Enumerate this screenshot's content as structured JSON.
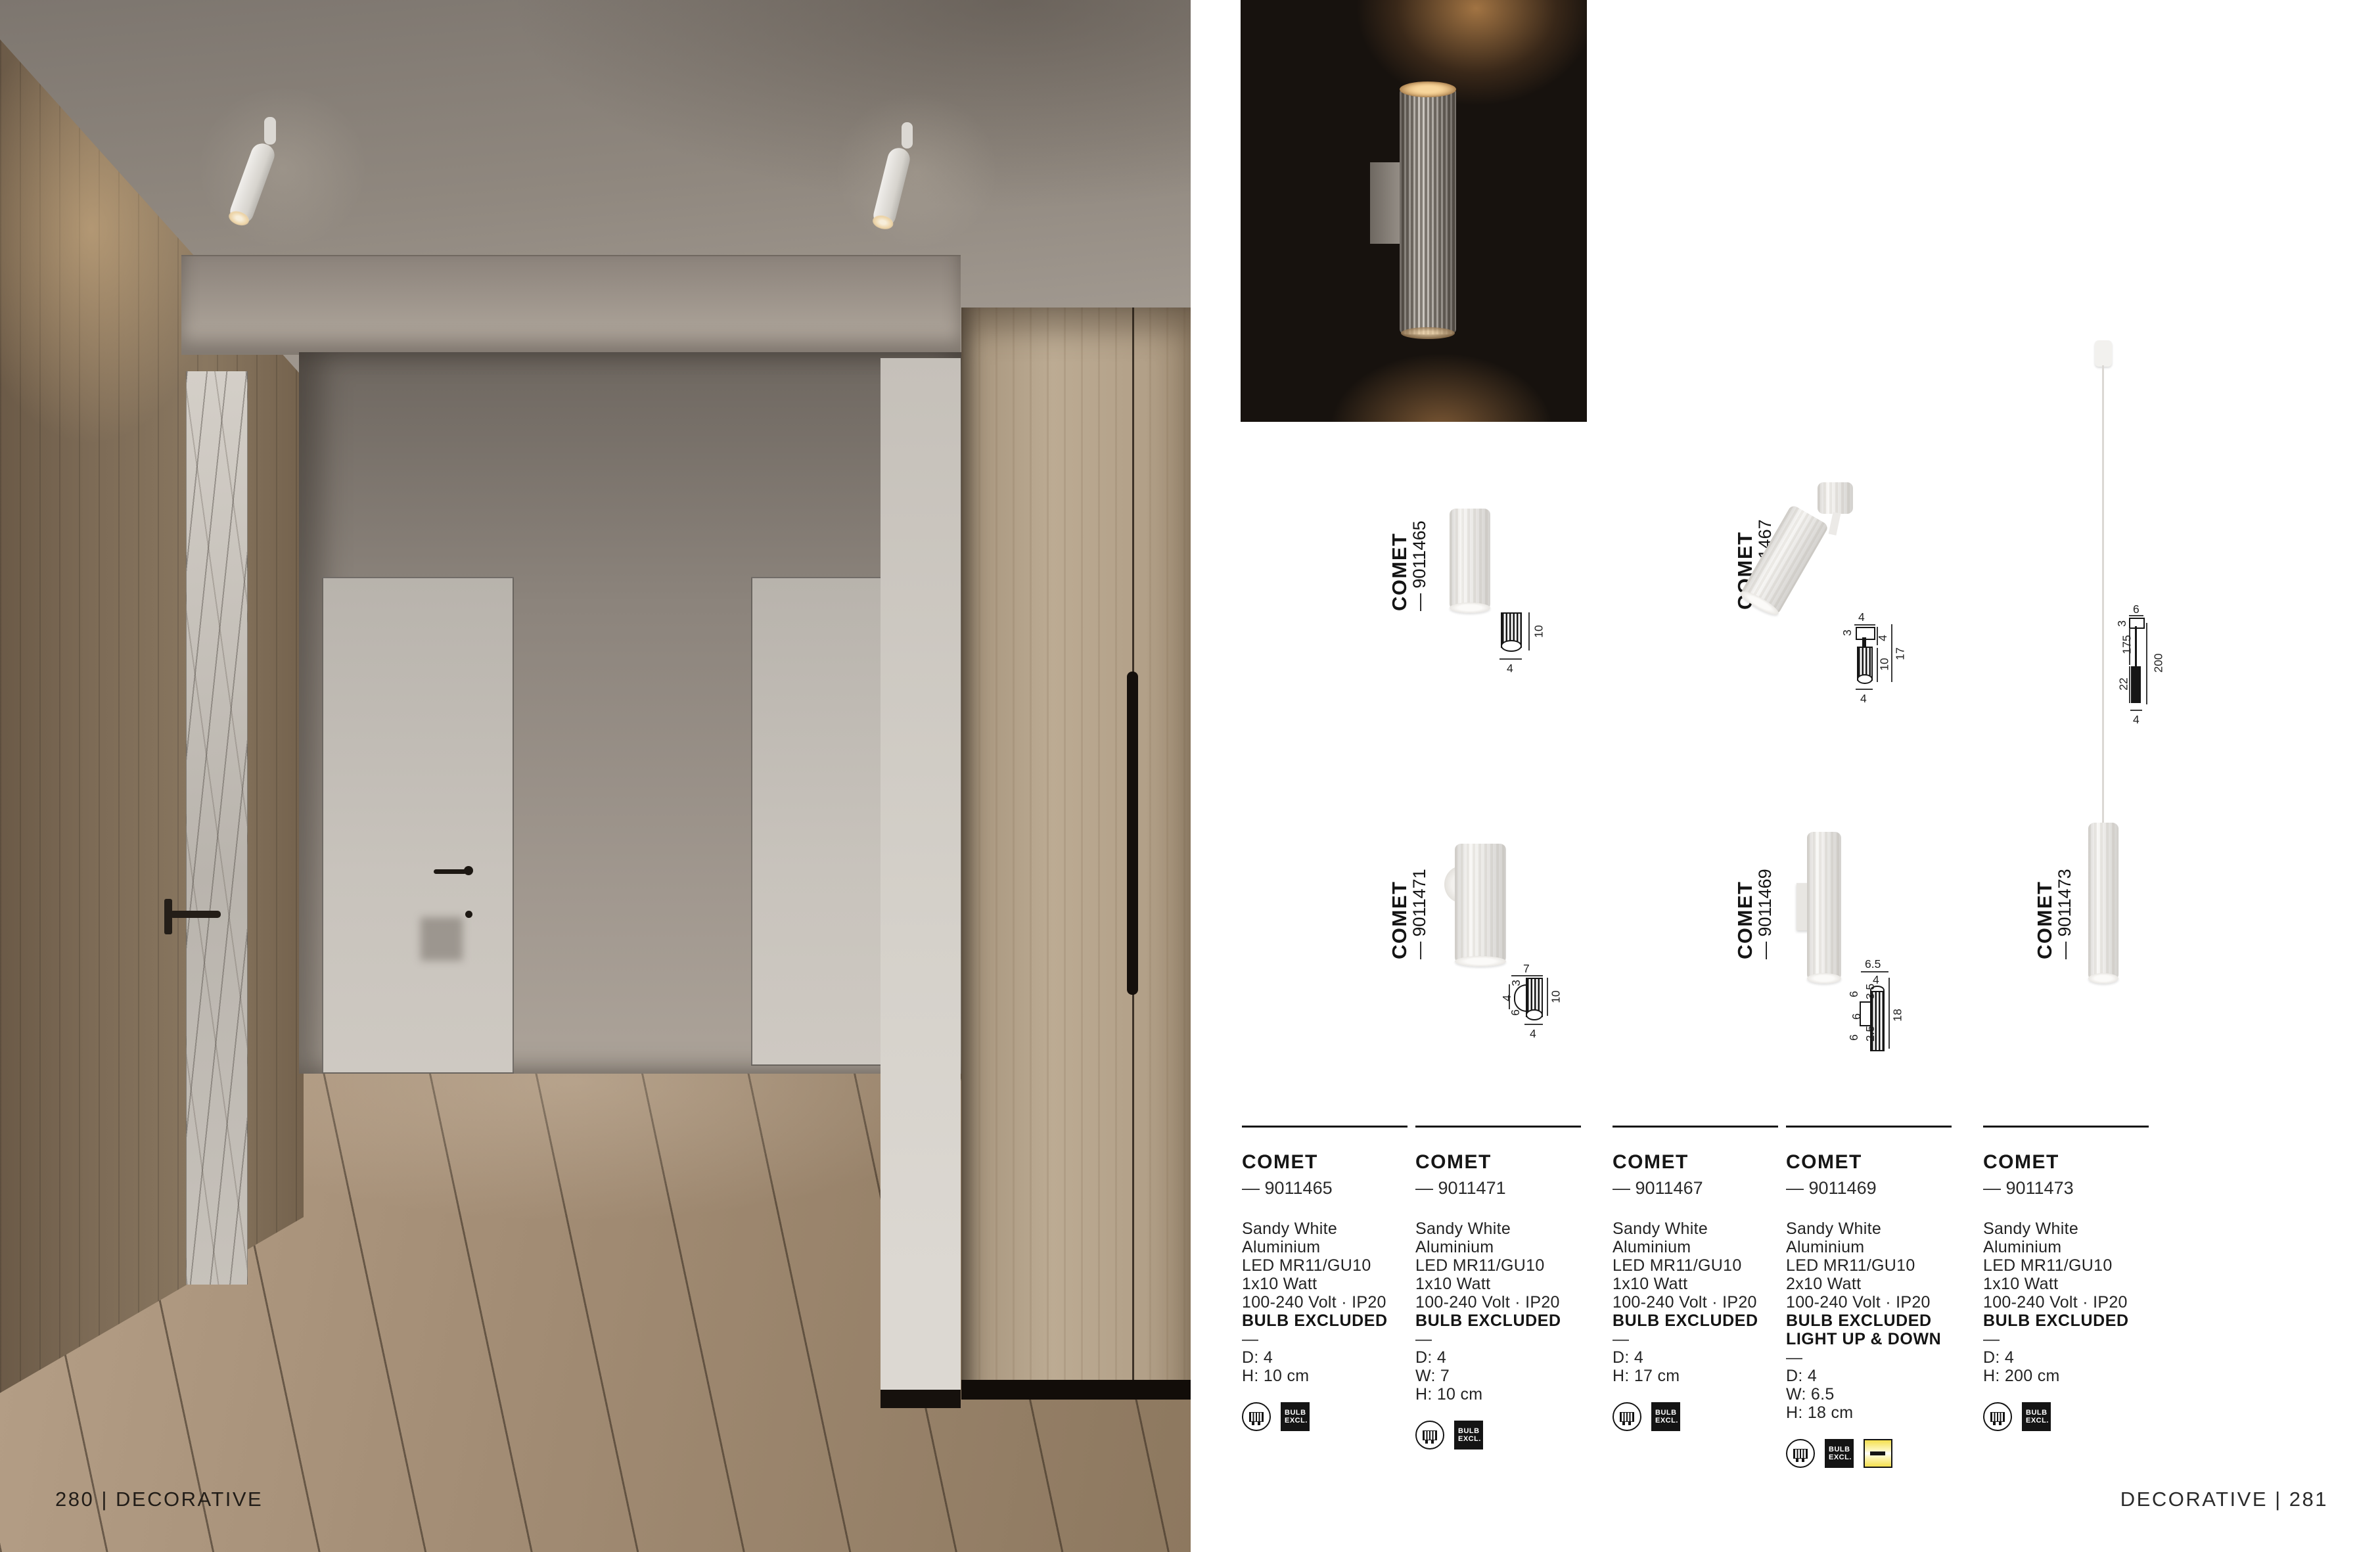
{
  "footer": {
    "left": "280 | DECORATIVE",
    "right": "DECORATIVE | 281"
  },
  "series": "COMET",
  "badge": {
    "line1": "BULB",
    "line2": "EXCL."
  },
  "products": [
    {
      "name": "COMET",
      "code": "— 9011465",
      "specs": [
        "Sandy White",
        "Aluminium",
        "LED MR11/GU10",
        "1x10 Watt",
        "100-240 Volt · IP20"
      ],
      "bold_lines": [
        "BULB EXCLUDED"
      ],
      "dash": "—",
      "dims": [
        "D: 4",
        "H: 10 cm"
      ],
      "icons": [
        "gu10-bulb-icon",
        "bulb-excluded-badge"
      ]
    },
    {
      "name": "COMET",
      "code": "— 9011471",
      "specs": [
        "Sandy White",
        "Aluminium",
        "LED MR11/GU10",
        "1x10 Watt",
        "100-240 Volt · IP20"
      ],
      "bold_lines": [
        "BULB EXCLUDED"
      ],
      "dash": "—",
      "dims": [
        "D: 4",
        "W: 7",
        "H: 10 cm"
      ],
      "icons": [
        "gu10-bulb-icon",
        "bulb-excluded-badge"
      ]
    },
    {
      "name": "COMET",
      "code": "— 9011467",
      "specs": [
        "Sandy White",
        "Aluminium",
        "LED MR11/GU10",
        "1x10 Watt",
        "100-240 Volt · IP20"
      ],
      "bold_lines": [
        "BULB EXCLUDED"
      ],
      "dash": "—",
      "dims": [
        "D: 4",
        "H: 17 cm"
      ],
      "icons": [
        "gu10-bulb-icon",
        "bulb-excluded-badge"
      ]
    },
    {
      "name": "COMET",
      "code": "— 9011469",
      "specs": [
        "Sandy White",
        "Aluminium",
        "LED MR11/GU10",
        "2x10 Watt",
        "100-240 Volt · IP20"
      ],
      "bold_lines": [
        "BULB EXCLUDED",
        "LIGHT UP & DOWN"
      ],
      "dash": "—",
      "dims": [
        "D: 4",
        "W: 6.5",
        "H: 18 cm"
      ],
      "icons": [
        "gu10-bulb-icon",
        "bulb-excluded-badge",
        "light-up-down-icon"
      ]
    },
    {
      "name": "COMET",
      "code": "— 9011473",
      "specs": [
        "Sandy White",
        "Aluminium",
        "LED MR11/GU10",
        "1x10 Watt",
        "100-240 Volt · IP20"
      ],
      "bold_lines": [
        "BULB EXCLUDED"
      ],
      "dash": "—",
      "dims": [
        "D: 4",
        "H: 200 cm"
      ],
      "icons": [
        "gu10-bulb-icon",
        "bulb-excluded-badge"
      ]
    }
  ],
  "drawings": {
    "d65": {
      "name": "COMET",
      "code": "— 9011465",
      "dim_right": "10",
      "dim_bottom": "4"
    },
    "d67": {
      "name": "COMET",
      "code": "— 9011467",
      "dim_top": "4",
      "dim_left": "3",
      "dim_r1": "4",
      "dim_r2": "10",
      "dim_r3": "17",
      "dim_bottom": "4"
    },
    "d71": {
      "name": "COMET",
      "code": "— 9011471",
      "dim_top": "7",
      "dim_l1": "3",
      "dim_l2": "4",
      "dim_l3": "6",
      "dim_right": "10",
      "dim_bottom": "4"
    },
    "d69": {
      "name": "COMET",
      "code": "— 9011469",
      "dim_top": "6.5",
      "dim_top2": "4",
      "dim_l1": "6",
      "dim_l2": "3.5",
      "dim_l3": "6",
      "dim_l4": "6",
      "dim_l5": "2.5",
      "dim_right": "18"
    },
    "d73": {
      "name": "COMET",
      "code": "— 9011473",
      "dim_top": "6",
      "dim_l1": "3",
      "dim_l2": "175",
      "dim_l3": "22",
      "dim_right": "200",
      "dim_bottom": "4"
    }
  },
  "colors": {
    "badge_black": "#141414",
    "icon_yellow": "#f4df4e",
    "photo_dark_bg": "#17120e",
    "page_bg": "#ffffff"
  }
}
